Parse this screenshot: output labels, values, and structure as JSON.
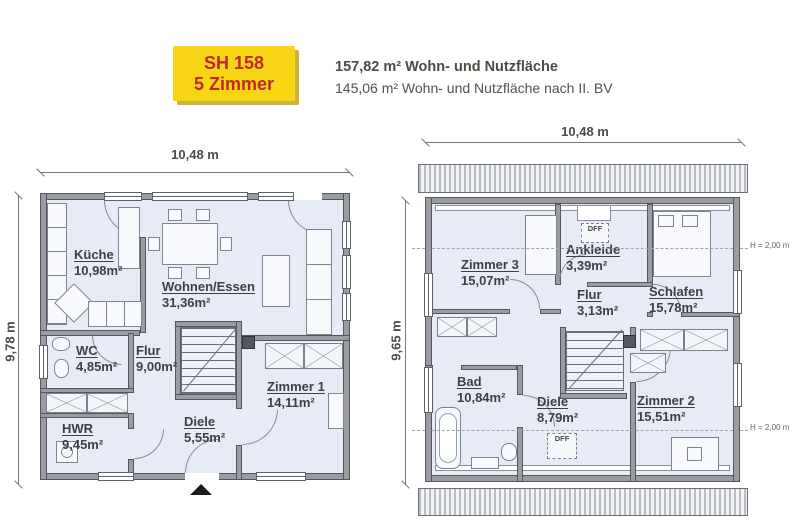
{
  "header": {
    "badge": {
      "line1": "SH 158",
      "line2": "5 Zimmer"
    },
    "area_total": "157,82 m² Wohn- und Nutzfläche",
    "area_bv": "145,06 m² Wohn- und Nutzfläche nach II. BV"
  },
  "colors": {
    "badge_yellow": "#f6d614",
    "badge_red": "#c2282a",
    "floor": "#e7ebf5",
    "wall_fill": "#9b9ba2",
    "wall_edge": "#54575e",
    "text_dark": "#3d3f44"
  },
  "ground_floor": {
    "width_label": "10,48 m",
    "height_label": "9,78 m",
    "rooms": [
      {
        "name": "Küche",
        "area": "10,98m²"
      },
      {
        "name": "Wohnen/Essen",
        "area": "31,36m²"
      },
      {
        "name": "WC",
        "area": "4,85m²"
      },
      {
        "name": "Flur",
        "area": "9,00m²"
      },
      {
        "name": "Zimmer 1",
        "area": "14,11m²"
      },
      {
        "name": "Diele",
        "area": "5,55m²"
      },
      {
        "name": "HWR",
        "area": "9,45m²"
      }
    ]
  },
  "upper_floor": {
    "width_label": "10,48 m",
    "height_label": "9,65 m",
    "rooms": [
      {
        "name": "Zimmer 3",
        "area": "15,07m²"
      },
      {
        "name": "Ankleide",
        "area": "3,39m²"
      },
      {
        "name": "Schlafen",
        "area": "15,78m²"
      },
      {
        "name": "Flur",
        "area": "3,13m²"
      },
      {
        "name": "Bad",
        "area": "10,84m²"
      },
      {
        "name": "Diele",
        "area": "8,79m²"
      },
      {
        "name": "Zimmer 2",
        "area": "15,51m²"
      }
    ],
    "notes": {
      "height_top": "H = 2,00 m",
      "height_bottom": "H = 2,00 m",
      "dff_top": "DFF",
      "dff_bottom": "DFF"
    }
  }
}
